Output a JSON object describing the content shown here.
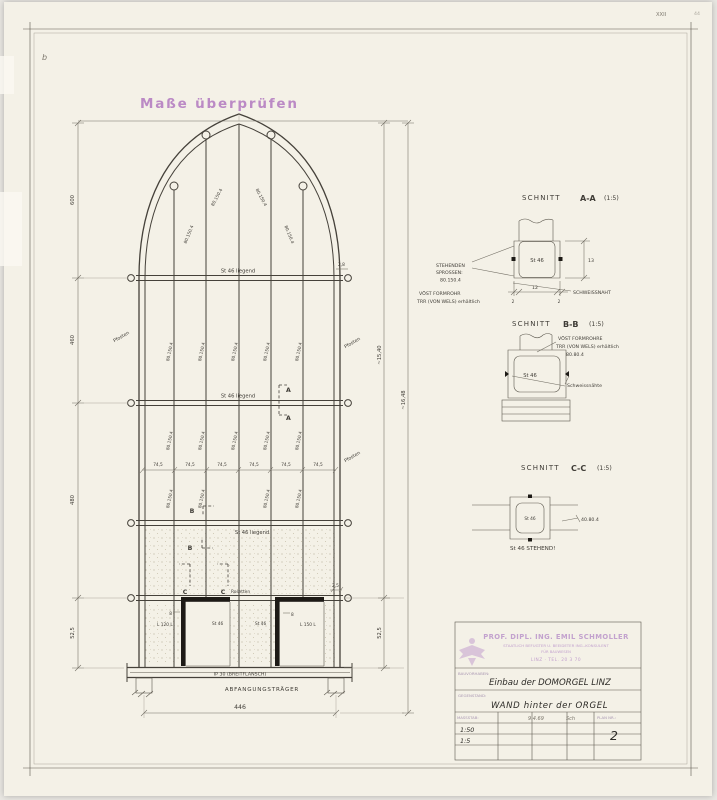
{
  "colors": {
    "paper": "#f4f1e7",
    "ink": "#3f3c36",
    "pencil": "#7b766c",
    "stamp_purple": "#b57fc2",
    "titleblock_purple": "#c3a2ce",
    "black": "#1d1a16"
  },
  "marks": {
    "corner_a": "XXII",
    "corner_b": "44",
    "scribble": "b"
  },
  "stamp_note": "Maße überprüfen",
  "elev": {
    "left_dims": [
      "600",
      "460",
      "480",
      "52,5"
    ],
    "right_dims": [
      "~15,40",
      "~16,48",
      "52,5"
    ],
    "bottom_dim": "446",
    "bay_dim": "74,5",
    "mullion_label": "80.150.4",
    "rail_label": "St 46 liegend",
    "pfosten": "Pfosten",
    "rosetten": "Rosetten",
    "door_labels": [
      "L 120 L",
      "St 46",
      "St 46",
      "L 150 L"
    ],
    "jamb_dim": "8",
    "header_dim": "2,5",
    "rail_end_dim": "2,8",
    "beam_label": "IP 30 (BREITFLANSCH)",
    "beam_name": "ABFANGUNGSTRÄGER",
    "marker_a": "A",
    "marker_b": "B",
    "marker_c": "C"
  },
  "sections": {
    "prefix": "SCHNITT",
    "a": {
      "name": "A-A",
      "scale": "(1:5)",
      "tube": "St 46",
      "note1": [
        "STEHENDEN",
        "SPROSSEN:",
        "80.150.4"
      ],
      "note2": [
        "VÖST FORMROHR",
        "TRR (VON WELS) erhältlich"
      ],
      "weld": "SCHWEISSNAHT",
      "dim_h": "13",
      "dim_w": "12",
      "dim_t": "2"
    },
    "b": {
      "name": "B-B",
      "scale": "(1:5)",
      "tube": "St 46",
      "note": [
        "VÖST FORMROHRE",
        "TRR (VON WELS) erhältlich",
        "80.80.4"
      ],
      "weld": "Schweissnähte"
    },
    "c": {
      "name": "C-C",
      "scale": "(1:5)",
      "tube": "St 46",
      "size": "40.80.4",
      "caption": "St 46 STEHEND!"
    }
  },
  "titleblock": {
    "firm": [
      "PROF. DIPL. ING. EMIL SCHMOLLER",
      "STAATLICH BEFUGTER U. BEEIDETER ING.-KONSULENT",
      "FÜR BAUWESEN",
      "LINZ · TEL. 20 3 70"
    ],
    "label_project": "BAUVORHABEN:",
    "project": "Einbau der DOMORGEL LINZ",
    "label_subject": "GEGENSTAND:",
    "subject": "WAND hinter der ORGEL",
    "label_scale": "MASSSTAB:",
    "scales": [
      "1:50",
      "1:5"
    ],
    "date": "9.4.69",
    "sig": "Sch",
    "label_plan": "PLAN NR.:",
    "plan_no": "2"
  }
}
